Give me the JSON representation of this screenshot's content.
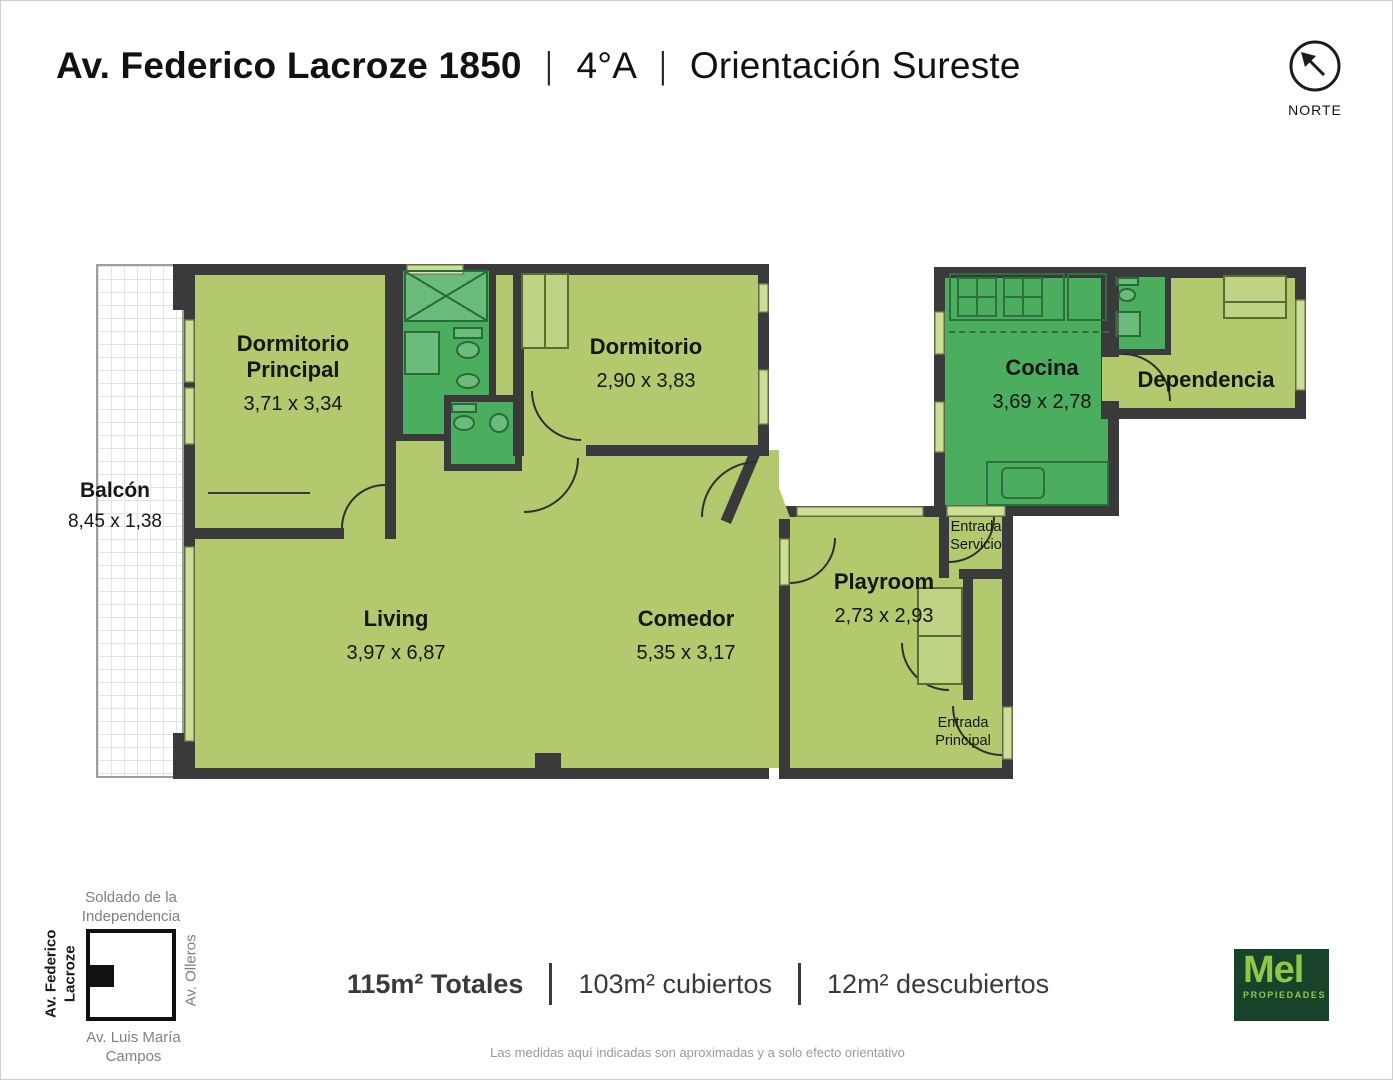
{
  "title": {
    "address": "Av. Federico Lacroze 1850",
    "separator": "|",
    "unit": "4°A",
    "orientation": "Orientación Sureste"
  },
  "north": {
    "label": "NORTE"
  },
  "rooms": {
    "dormitorio_principal": {
      "name": "Dormitorio Principal",
      "dims": "3,71 x 3,34"
    },
    "dormitorio": {
      "name": "Dormitorio",
      "dims": "2,90 x 3,83"
    },
    "balcon": {
      "name": "Balcón",
      "dims": "8,45 x 1,38"
    },
    "living": {
      "name": "Living",
      "dims": "3,97 x 6,87"
    },
    "comedor": {
      "name": "Comedor",
      "dims": "5,35 x 3,17"
    },
    "playroom": {
      "name": "Playroom",
      "dims": "2,73 x 2,93"
    },
    "cocina": {
      "name": "Cocina",
      "dims": "3,69 x 2,78"
    },
    "dependencia": {
      "name": "Dependencia"
    },
    "entrada_servicio": {
      "name": "Entrada Servicio"
    },
    "entrada_principal": {
      "name": "Entrada Principal"
    }
  },
  "block_map": {
    "top": "Soldado de la Independencia",
    "left": "Av. Federico Lacroze",
    "right": "Av. Olleros",
    "bottom": "Av. Luis María Campos"
  },
  "summary": {
    "total": "115m² Totales",
    "covered": "103m² cubiertos",
    "uncovered": "12m² descubiertos"
  },
  "disclaimer": "Las medidas aquí indicadas son aproximadas y a solo efecto orientativo",
  "logo": {
    "brand": "Mel",
    "tagline": "PROPIEDADES"
  },
  "colors": {
    "room_fill": "#b3c96e",
    "wet_room_fill": "#4bad5e",
    "window_fill": "#cede96",
    "wall": "#3a3a3c",
    "logo_bg": "#17432a",
    "logo_text": "#8fc846"
  }
}
